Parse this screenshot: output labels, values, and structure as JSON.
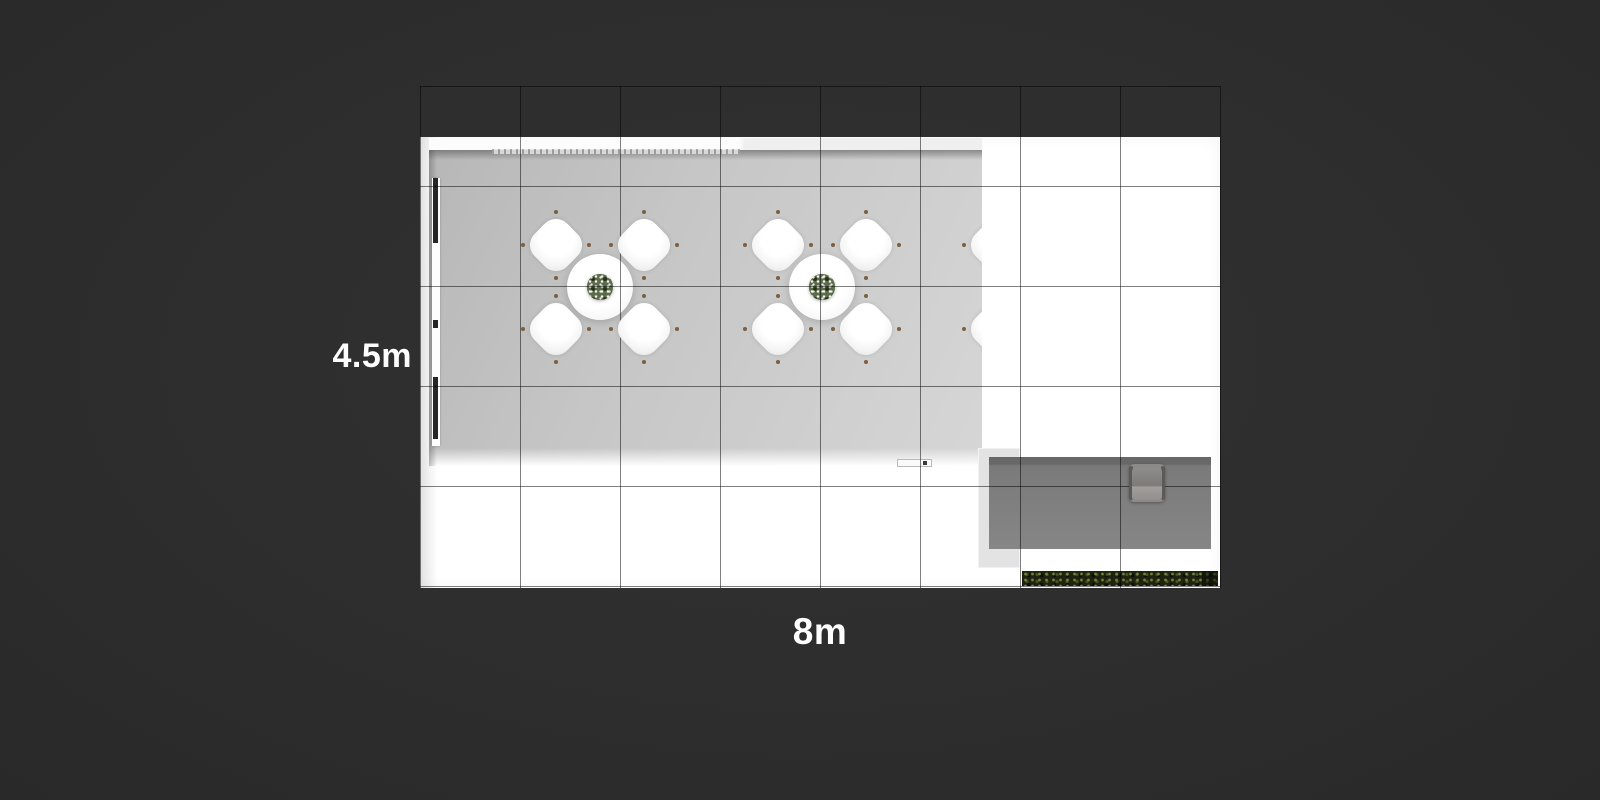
{
  "scene": {
    "description": "Top-down render of an 8m x 4.5m exhibition booth floor plan on a dark background with a 1m measurement grid",
    "grid": {
      "cell_meters": 1,
      "columns": 8,
      "rows": 5
    }
  },
  "dimensions": {
    "width_label": "8m",
    "height_label": "4.5m"
  },
  "furniture": {
    "chairs_per_table": 4,
    "dining_sets": [
      {
        "cx": 600,
        "cy": 287,
        "partial": false
      },
      {
        "cx": 822,
        "cy": 287,
        "partial": false
      },
      {
        "cx": 1041,
        "cy": 287,
        "partial": true
      }
    ],
    "chair_offsets": [
      [
        -44,
        -42
      ],
      [
        44,
        -42
      ],
      [
        -44,
        42
      ],
      [
        44,
        42
      ]
    ],
    "foot_offsets": [
      [
        0,
        -33
      ],
      [
        33,
        0
      ],
      [
        0,
        33
      ],
      [
        -33,
        0
      ]
    ]
  },
  "colors": {
    "background": "#2e2e2e",
    "floor": "#ffffff",
    "room_floor": "#c7c7c7",
    "storage_box": "#7a7a7a",
    "hedge_green": "#1d2310",
    "chair_foot": "#7d5e43",
    "bouquet_green": "#5c6c48",
    "label_text": "#ffffff"
  }
}
